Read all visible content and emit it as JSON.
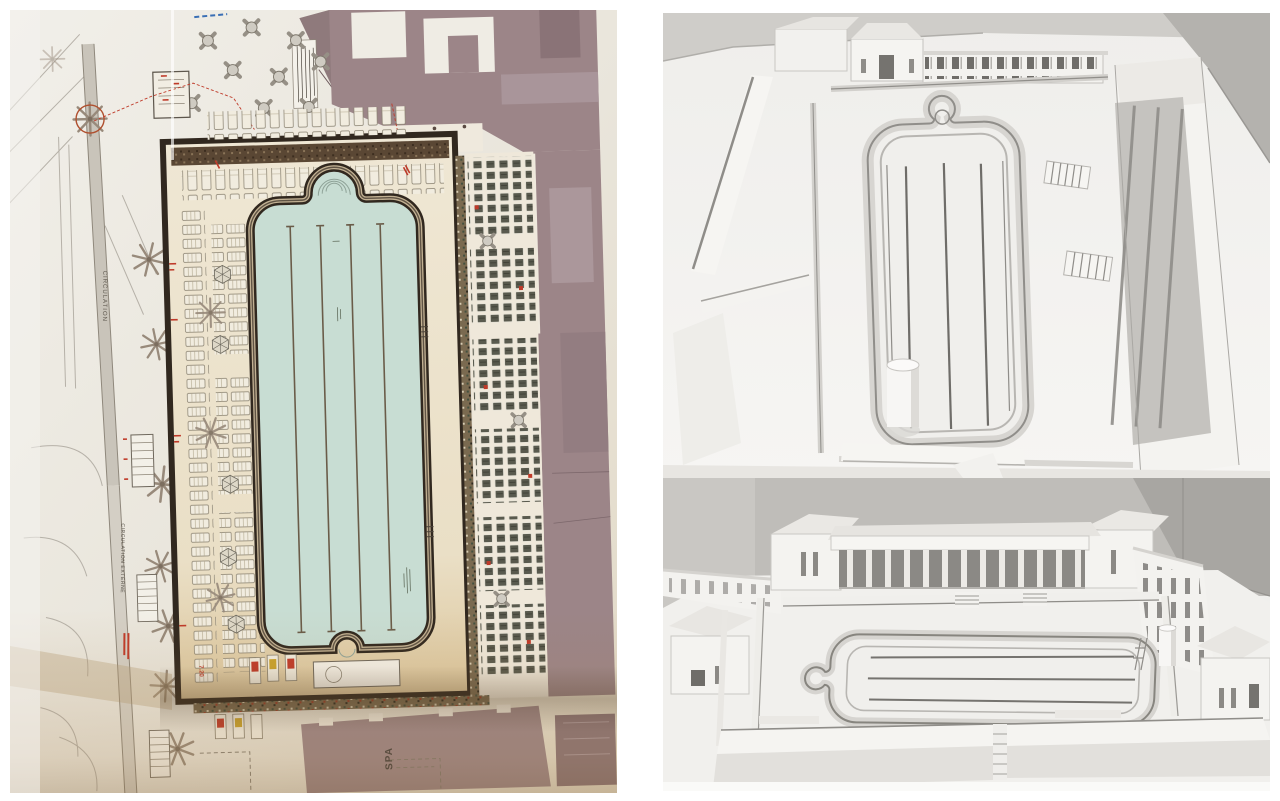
{
  "page": {
    "kind": "collage of a swimming-pool architectural site plan and two white model photographs",
    "background": "#ffffff"
  },
  "left_panel": {
    "kind": "photograph of printed site plan",
    "labels": {
      "circulation": "CIRCULATION",
      "circulation_externe": "CIRCULATION EXTERNE",
      "spa": "SPA",
      "dim_720": "7.20"
    },
    "colors": {
      "paper": "#eae7df",
      "paper_light": "#f2f0ea",
      "deck": "#ede4d0",
      "deck_warm": "#dcc69c",
      "water": "#c8ddd3",
      "frame_dark": "#31281f",
      "building_mauve": "#9c8588",
      "building_mauve_dark": "#8a7377",
      "annotation_red": "#bf3a29",
      "sunbed_dark": "#5d5e52",
      "palm_gray": "#988a7b",
      "pergola_brown": "#5a4734"
    }
  },
  "right_panel": {
    "top_photo": {
      "kind": "white architectural model, aerial view of pool",
      "colors": {
        "wall": "#cfcdc9",
        "wall_dark": "#b4b2ae",
        "model": "#f3f2ef",
        "shadow": "#d7d5d1",
        "line": "#8f8d89"
      }
    },
    "bottom_photo": {
      "kind": "white architectural model, oblique view with colonnade pavilion",
      "colors": {
        "wall": "#bfbdb9",
        "wall_dark": "#a8a6a2",
        "model": "#f0efec",
        "shadow": "#d5d3cf",
        "line": "#87857f"
      }
    }
  }
}
